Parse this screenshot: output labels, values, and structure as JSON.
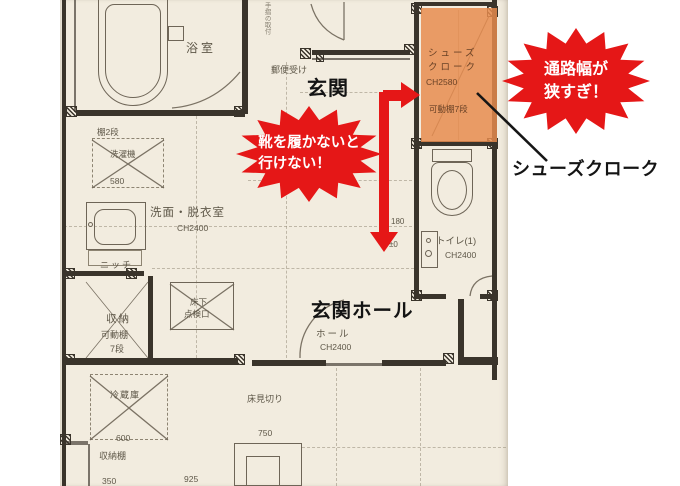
{
  "colors": {
    "red": "#e51717",
    "orange": "rgba(231,140,78,.84)",
    "paper": "#f2ecdf",
    "ink": "#5e5748",
    "wall": "#3a342b",
    "boldink": "#141414"
  },
  "annotations": {
    "shoes_warning": {
      "line1": "靴を履かないと",
      "line2": "行けない！"
    },
    "width_warning": {
      "line1": "通路幅が",
      "line2": "狭すぎ！"
    },
    "callout": "シューズクローク"
  },
  "plan": {
    "labels": {
      "bathroom": "浴室",
      "mailbox": "郵便受け",
      "entrance": "玄関",
      "shelf_2": "棚2段",
      "washer": "洗濯機",
      "dim_580": "580",
      "laundry": "洗面・脱衣室",
      "laundry_ch": "CH2400",
      "niche": "ニッチ",
      "storage": "収納",
      "storage_shelf": "可動棚",
      "storage_tiers": "7段",
      "hatch_1": "床下",
      "hatch_2": "点検口",
      "fridge": "冷蔵庫",
      "dim_600": "600",
      "rack": "収納棚",
      "dim_350": "350",
      "dim_925": "925",
      "floor_edge": "床見切り",
      "dim_750": "750",
      "dim_180": "180",
      "dim_pm0": "±0",
      "toilet": "トイレ(1)",
      "toilet_ch": "CH2400",
      "hall_bold": "玄関ホール",
      "hall": "ホール",
      "hall_ch": "CH2400",
      "cloak_1": "シューズ",
      "cloak_2": "クローク",
      "cloak_ch": "CH2580",
      "cloak_shelf": "可動棚7段",
      "side_note": "手摺の取付"
    }
  }
}
